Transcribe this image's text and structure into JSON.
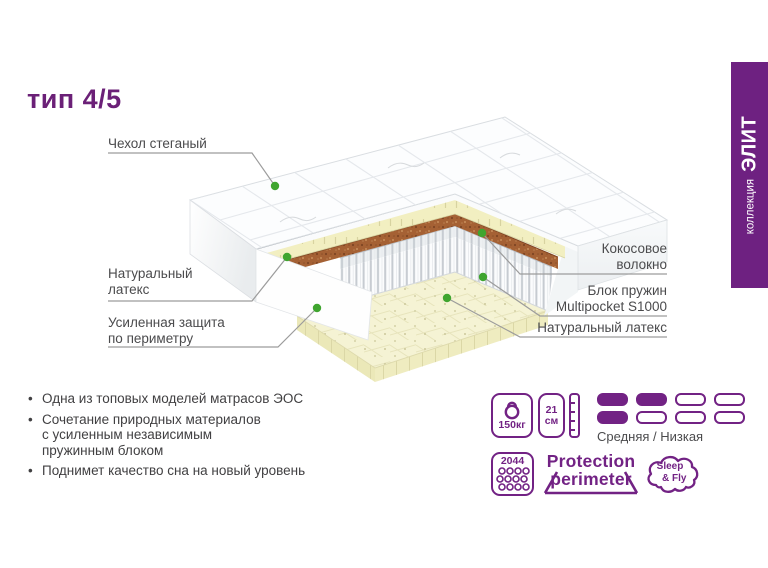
{
  "title": "тип 4/5",
  "collection_banner": {
    "prefix": "коллекция",
    "name": "ЭЛИТ"
  },
  "callouts": {
    "cover": {
      "lines": [
        "Чехол стеганый"
      ]
    },
    "latex_left": {
      "lines": [
        "Натуральный",
        "латекс"
      ]
    },
    "perimeter": {
      "lines": [
        "Усиленная защита",
        "по периметру"
      ]
    },
    "coconut": {
      "lines": [
        "Кокосовое",
        "волокно"
      ]
    },
    "springs": {
      "lines": [
        "Блок пружин",
        "Multipocket S1000"
      ]
    },
    "latex_right": {
      "lines": [
        "Натуральный латекс"
      ]
    }
  },
  "features": [
    {
      "lines": [
        "Одна из топовых моделей матрасов ЭОС"
      ]
    },
    {
      "lines": [
        "Сочетание природных материалов",
        "с усиленным независимым",
        "пружинным блоком"
      ]
    },
    {
      "lines": [
        "Поднимет качество сна на новый уровень"
      ]
    }
  ],
  "specs": {
    "max_weight": "150кг",
    "height_value": "21",
    "height_unit": "см",
    "springs_count": "2044",
    "firmness_label": "Средняя / Низкая",
    "firmness_pattern": [
      [
        1,
        1,
        0,
        0
      ],
      [
        1,
        0,
        0,
        0
      ]
    ]
  },
  "logos": {
    "protection_line1": "Protection",
    "protection_line2": "perimeter",
    "brand_line1": "Sleep",
    "brand_line2": "& Fly"
  },
  "colors": {
    "accent": "#722284",
    "banner": "#6e2181",
    "callout_dot": "#3fa52f"
  }
}
